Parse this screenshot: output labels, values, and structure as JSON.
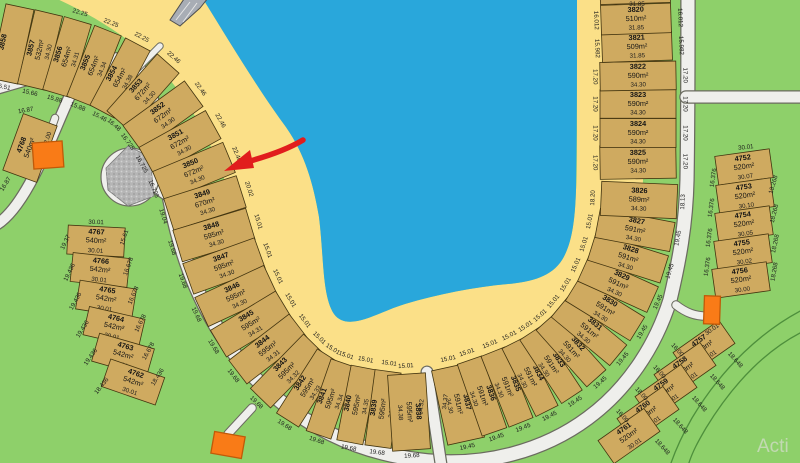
{
  "map": {
    "watermark": "Acti",
    "annotation": {
      "type": "red-arrow",
      "points_to_lot": "3850",
      "color": "#e11d1d"
    },
    "palette": {
      "water": "#29a7db",
      "beach": "#fbe088",
      "green": "#8ed06a",
      "lot_fill": "#cfaa60",
      "road": "#efefec",
      "road_edge": "#6b6b60",
      "gray_island": "#b5b5b5",
      "building": "#f97b17",
      "arrow": "#e11d1d"
    },
    "arc_band_depth": 76,
    "arc_lots": [
      {
        "num": "3858",
        "area": "",
        "depth": "",
        "front": "",
        "back": "15.51",
        "cx": 12,
        "cy": 44
      },
      {
        "num": "3857",
        "area": "532m²",
        "depth": "34.30",
        "front": "",
        "back": "15.66",
        "cx": 40,
        "cy": 50
      },
      {
        "num": "3856",
        "area": "654m²",
        "depth": "34.31",
        "front": "22.25",
        "back": "15.88",
        "cx": 67,
        "cy": 57
      },
      {
        "num": "3855",
        "area": "654m²",
        "depth": "34.34",
        "front": "22.25",
        "back": "15.88",
        "cx": 94,
        "cy": 66
      },
      {
        "num": "3854",
        "area": "654m²",
        "depth": "34.38",
        "front": "22.25",
        "back": "15.46",
        "cx": 120,
        "cy": 78
      },
      {
        "num": "3853",
        "area": "672m²",
        "depth": "34.30",
        "front": "22.46",
        "back": "16.48",
        "cx": 143,
        "cy": 92
      },
      {
        "num": "3852",
        "area": "672m²",
        "depth": "34.30",
        "front": "22.46",
        "back": "16.725",
        "cx": 163,
        "cy": 116
      },
      {
        "num": "3851",
        "area": "672m²",
        "depth": "34.30",
        "front": "22.46",
        "back": "16.725",
        "cx": 180,
        "cy": 143
      },
      {
        "num": "3850",
        "area": "672m²",
        "depth": "34.30",
        "front": "22.46",
        "back": "16.725",
        "cx": 194,
        "cy": 172
      },
      {
        "num": "3849",
        "area": "670m²",
        "depth": "34.30",
        "front": "20.02",
        "back": "19.04",
        "cx": 205,
        "cy": 203
      },
      {
        "num": "3848",
        "area": "595m²",
        "depth": "34.30",
        "front": "15.01",
        "back": "19.68",
        "cx": 214,
        "cy": 235
      },
      {
        "num": "3847",
        "area": "595m²",
        "depth": "34.30",
        "front": "15.01",
        "back": "19.68",
        "cx": 224,
        "cy": 266
      },
      {
        "num": "3846",
        "area": "595m²",
        "depth": "34.30",
        "front": "15.01",
        "back": "19.68",
        "cx": 236,
        "cy": 296
      },
      {
        "num": "3845",
        "area": "595m²",
        "depth": "34.31",
        "front": "15.01",
        "back": "19.68",
        "cx": 251,
        "cy": 324
      },
      {
        "num": "3844",
        "area": "595m²",
        "depth": "34.31",
        "front": "15.01",
        "back": "19.68",
        "cx": 268,
        "cy": 349
      },
      {
        "num": "3843",
        "area": "595m²",
        "depth": "34.32",
        "front": "15.01",
        "back": "19.68",
        "cx": 287,
        "cy": 371
      },
      {
        "num": "3842",
        "area": "595m²",
        "depth": "34.33",
        "front": "15.01",
        "back": "19.68",
        "cx": 308,
        "cy": 388
      },
      {
        "num": "3841",
        "area": "595m²",
        "depth": "34.34",
        "front": "15.01",
        "back": "19.68",
        "cx": 331,
        "cy": 399
      },
      {
        "num": "3840",
        "area": "595m²",
        "depth": "34.35",
        "front": "15.01",
        "back": "19.68",
        "cx": 357,
        "cy": 405
      },
      {
        "num": "3839",
        "area": "595m²",
        "depth": "34.36",
        "front": "15.01",
        "back": "19.68",
        "cx": 383,
        "cy": 409
      },
      {
        "num": "3838",
        "area": "595m²",
        "depth": "34.38",
        "front": "15.01",
        "back": "19.68",
        "cx": 409,
        "cy": 412
      },
      {
        "num": "3837",
        "area": "591m²",
        "depth": "34.30",
        "front": "15.01",
        "back": "19.45",
        "cx": 458,
        "cy": 404
      },
      {
        "num": "3836",
        "area": "591m²",
        "depth": "34.30",
        "front": "15.01",
        "back": "19.45",
        "cx": 482,
        "cy": 396
      },
      {
        "num": "3835",
        "area": "591m²",
        "depth": "34.30",
        "front": "15.01",
        "back": "19.45",
        "cx": 507,
        "cy": 387
      },
      {
        "num": "3834",
        "area": "591m²",
        "depth": "34.30",
        "front": "15.01",
        "back": "19.45",
        "cx": 530,
        "cy": 377
      },
      {
        "num": "3833",
        "area": "591m²",
        "depth": "34.30",
        "front": "15.01",
        "back": "19.45",
        "cx": 551,
        "cy": 365
      },
      {
        "num": "3832",
        "area": "591m²",
        "depth": "34.30",
        "front": "15.01",
        "back": "19.45",
        "cx": 571,
        "cy": 350
      },
      {
        "num": "3831",
        "area": "591m²",
        "depth": "34.30",
        "front": "15.01",
        "back": "19.45",
        "cx": 589,
        "cy": 331
      },
      {
        "num": "3830",
        "area": "591m²",
        "depth": "34.30",
        "front": "15.01",
        "back": "19.45",
        "cx": 605,
        "cy": 309
      },
      {
        "num": "3829",
        "area": "591m²",
        "depth": "34.30",
        "front": "15.01",
        "back": "19.45",
        "cx": 618,
        "cy": 284
      },
      {
        "num": "3828",
        "area": "591m²",
        "depth": "34.30",
        "front": "15.01",
        "back": "19.45",
        "cx": 628,
        "cy": 258
      },
      {
        "num": "3827",
        "area": "591m²",
        "depth": "34.30",
        "front": "15.01",
        "back": "19.45",
        "cx": 635,
        "cy": 230
      },
      {
        "num": "3826",
        "area": "589m²",
        "depth": "34.30",
        "front": "18.20",
        "back": "18.13",
        "cx": 639,
        "cy": 200
      },
      {
        "num": "3825",
        "area": "590m²",
        "depth": "34.30",
        "front": "17.20",
        "back": "17.20",
        "cx": 638,
        "cy": 162
      },
      {
        "num": "3824",
        "area": "590m²",
        "depth": "34.30",
        "front": "17.20",
        "back": "17.20",
        "cx": 638,
        "cy": 133
      },
      {
        "num": "3823",
        "area": "590m²",
        "depth": "34.30",
        "front": "17.20",
        "back": "17.20",
        "cx": 638,
        "cy": 104
      },
      {
        "num": "3822",
        "area": "590m²",
        "depth": "34.30",
        "front": "17.20",
        "back": "17.20",
        "cx": 638,
        "cy": 76
      },
      {
        "num": "3821",
        "area": "509m²",
        "depth": "31.85",
        "front": "15.982",
        "back": "15.982",
        "cx": 637,
        "cy": 47,
        "d": 70
      },
      {
        "num": "3820",
        "area": "510m²",
        "depth": "31.85",
        "front": "16.012",
        "back": "16.012",
        "cx": 636,
        "cy": 19,
        "d": 70
      },
      {
        "num": "",
        "area": "",
        "depth": "",
        "front": "",
        "back": "",
        "cx": 635,
        "cy": -12,
        "d": 70
      }
    ],
    "columns": [
      {
        "name": "left-column",
        "w": 57,
        "h": 29,
        "lots": [
          {
            "num": "4767",
            "area": "540m²",
            "dim": "30.01",
            "cx": 96,
            "cy": 241,
            "rot": 3
          },
          {
            "num": "4766",
            "area": "542m²",
            "dim": "30.01",
            "cx": 100,
            "cy": 270,
            "rot": 6
          },
          {
            "num": "4765",
            "area": "542m²",
            "dim": "30.01",
            "cx": 106,
            "cy": 299,
            "rot": 9
          },
          {
            "num": "4764",
            "area": "542m²",
            "dim": "30.01",
            "cx": 114,
            "cy": 327,
            "rot": 13
          },
          {
            "num": "4763",
            "area": "542m²",
            "dim": "30.01",
            "cx": 123,
            "cy": 355,
            "rot": 16
          },
          {
            "num": "4762",
            "area": "542m²",
            "dim": "30.01",
            "cx": 133,
            "cy": 382,
            "rot": 19
          }
        ]
      },
      {
        "name": "lot-4768",
        "w": 36,
        "h": 60,
        "lots": [
          {
            "num": "4768",
            "area": "540m²",
            "dim": "",
            "cx": 30,
            "cy": 148,
            "rot": 20,
            "tr": -70
          }
        ]
      },
      {
        "name": "right-column-a",
        "w": 55,
        "h": 29,
        "lots": [
          {
            "num": "4752",
            "area": "520m²",
            "dim": "30.07",
            "cx": 744,
            "cy": 167,
            "rot": -8
          },
          {
            "num": "4753",
            "area": "520m²",
            "dim": "30.10",
            "cx": 745,
            "cy": 196,
            "rot": -8
          },
          {
            "num": "4754",
            "area": "520m²",
            "dim": "30.05",
            "cx": 744,
            "cy": 224,
            "rot": -8
          },
          {
            "num": "4755",
            "area": "520m²",
            "dim": "30.02",
            "cx": 743,
            "cy": 252,
            "rot": -8
          },
          {
            "num": "4756",
            "area": "520m²",
            "dim": "30.00",
            "cx": 741,
            "cy": 280,
            "rot": -8
          }
        ]
      },
      {
        "name": "right-column-b",
        "w": 56,
        "h": 28,
        "lots": [
          {
            "num": "4757",
            "area": "520m²",
            "dim": "30.01",
            "cx": 704,
            "cy": 348,
            "rot": -35
          },
          {
            "num": "4758",
            "area": "520m²",
            "dim": "30.01",
            "cx": 685,
            "cy": 370,
            "rot": -35
          },
          {
            "num": "4759",
            "area": "520m²",
            "dim": "30.01",
            "cx": 666,
            "cy": 392,
            "rot": -35
          },
          {
            "num": "4760",
            "area": "520m²",
            "dim": "30.01",
            "cx": 648,
            "cy": 414,
            "rot": -35
          },
          {
            "num": "4761",
            "area": "520m²",
            "dim": "30.01",
            "cx": 629,
            "cy": 436,
            "rot": -35
          }
        ]
      }
    ],
    "extra_labels": [
      {
        "t": "30.01",
        "x": 96,
        "y": 224,
        "r": 2
      },
      {
        "t": "19.37",
        "x": 67,
        "y": 243,
        "r": -65
      },
      {
        "t": "19.436",
        "x": 71,
        "y": 273,
        "r": -64
      },
      {
        "t": "19.436",
        "x": 77,
        "y": 302,
        "r": -61
      },
      {
        "t": "19.436",
        "x": 84,
        "y": 330,
        "r": -58
      },
      {
        "t": "19.436",
        "x": 92,
        "y": 358,
        "r": -55
      },
      {
        "t": "18.436",
        "x": 103,
        "y": 387,
        "r": -52
      },
      {
        "t": "15.61",
        "x": 126,
        "y": 238,
        "r": -72
      },
      {
        "t": "16.678",
        "x": 130,
        "y": 267,
        "r": -70
      },
      {
        "t": "16.678",
        "x": 135,
        "y": 296,
        "r": -67
      },
      {
        "t": "16.678",
        "x": 142,
        "y": 324,
        "r": -64
      },
      {
        "t": "16.678",
        "x": 150,
        "y": 352,
        "r": -61
      },
      {
        "t": "18.436",
        "x": 159,
        "y": 378,
        "r": -58
      },
      {
        "t": "16.87",
        "x": 26,
        "y": 112,
        "r": -10
      },
      {
        "t": "32.00",
        "x": 49,
        "y": 140,
        "r": -72
      },
      {
        "t": "16.87",
        "x": 7,
        "y": 185,
        "r": -58
      },
      {
        "t": "30.01",
        "x": 746,
        "y": 149,
        "r": -6
      },
      {
        "t": "16.376",
        "x": 715,
        "y": 178,
        "r": -82
      },
      {
        "t": "16.376",
        "x": 713,
        "y": 208,
        "r": -82
      },
      {
        "t": "16.376",
        "x": 711,
        "y": 238,
        "r": -82
      },
      {
        "t": "16.376",
        "x": 709,
        "y": 267,
        "r": -82
      },
      {
        "t": "18.268",
        "x": 775,
        "y": 185,
        "r": -74
      },
      {
        "t": "18.268",
        "x": 776,
        "y": 214,
        "r": -76
      },
      {
        "t": "18.268",
        "x": 777,
        "y": 244,
        "r": -78
      },
      {
        "t": "18.268",
        "x": 776,
        "y": 272,
        "r": -80
      },
      {
        "t": "30.01",
        "x": 713,
        "y": 331,
        "r": -36
      },
      {
        "t": "18.648",
        "x": 734,
        "y": 361,
        "r": 48
      },
      {
        "t": "18.648",
        "x": 716,
        "y": 383,
        "r": 48
      },
      {
        "t": "18.648",
        "x": 698,
        "y": 405,
        "r": 48
      },
      {
        "t": "18.648",
        "x": 679,
        "y": 427,
        "r": 48
      },
      {
        "t": "18.648",
        "x": 661,
        "y": 448,
        "r": 48
      },
      {
        "t": "16.00",
        "x": 676,
        "y": 351,
        "r": 48
      },
      {
        "t": "16.00",
        "x": 658,
        "y": 373,
        "r": 48
      },
      {
        "t": "18.00",
        "x": 640,
        "y": 395,
        "r": 48
      },
      {
        "t": "16.00",
        "x": 621,
        "y": 417,
        "r": 48
      },
      {
        "t": "34.32",
        "x": 423,
        "y": 407,
        "r": -85
      },
      {
        "t": "34.37",
        "x": 447,
        "y": 402,
        "r": -83
      },
      {
        "t": "31.85",
        "x": 637,
        "y": 6,
        "r": 0
      }
    ]
  }
}
